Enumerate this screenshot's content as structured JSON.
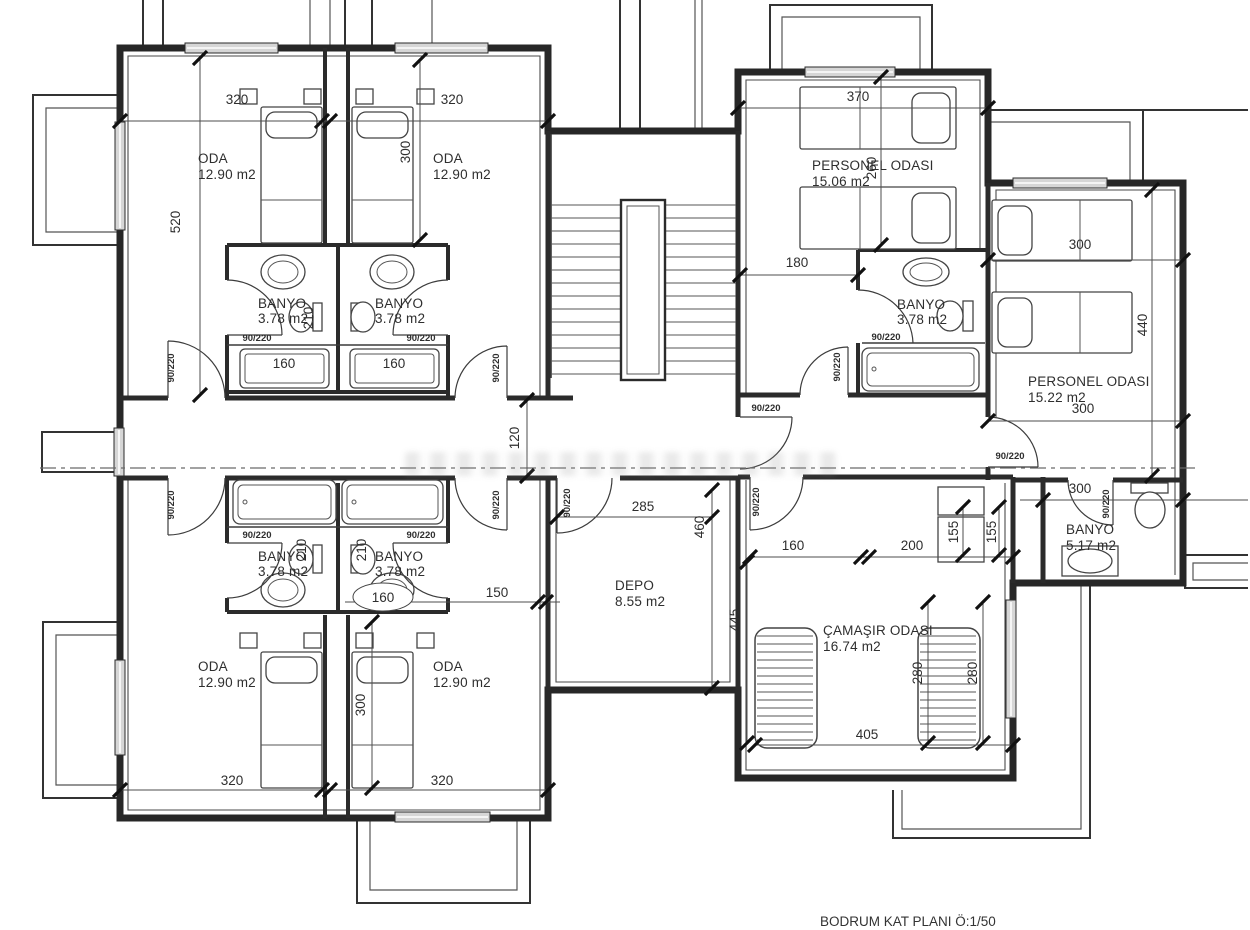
{
  "title": "BODRUM KAT PLANI Ö:1/50",
  "door": "90/220",
  "rooms": {
    "oda_tl": {
      "name": "ODA",
      "area": "12.90 m2"
    },
    "oda_tr": {
      "name": "ODA",
      "area": "12.90 m2"
    },
    "oda_bl": {
      "name": "ODA",
      "area": "12.90 m2"
    },
    "oda_br": {
      "name": "ODA",
      "area": "12.90 m2"
    },
    "banyo_tl": {
      "name": "BANYO",
      "area": "3.78 m2"
    },
    "banyo_tr": {
      "name": "BANYO",
      "area": "3.78 m2"
    },
    "banyo_bl": {
      "name": "BANYO",
      "area": "3.78 m2"
    },
    "banyo_br": {
      "name": "BANYO",
      "area": "3.78 m2"
    },
    "personel_odasi_1": {
      "name": "PERSONEL ODASI",
      "area": "15.06 m2"
    },
    "personel_banyo": {
      "name": "BANYO",
      "area": "3.78 m2"
    },
    "personel_odasi_2": {
      "name": "PERSONEL ODASI",
      "area": "15.22 m2"
    },
    "banyo_right": {
      "name": "BANYO",
      "area": "5.17 m2"
    },
    "depo": {
      "name": "DEPO",
      "area": "8.55 m2"
    },
    "camasir_odasi": {
      "name": "ÇAMAŞIR ODASI",
      "area": "16.74 m2"
    }
  },
  "dims": {
    "d120": "120",
    "d150": "150",
    "d155": "155",
    "d160": "160",
    "d180": "180",
    "d200": "200",
    "d210": "210",
    "d260": "260",
    "d280": "280",
    "d285": "285",
    "d300": "300",
    "d320": "320",
    "d370": "370",
    "d405": "405",
    "d440": "440",
    "d445": "445",
    "d460": "460",
    "d520": "520"
  }
}
